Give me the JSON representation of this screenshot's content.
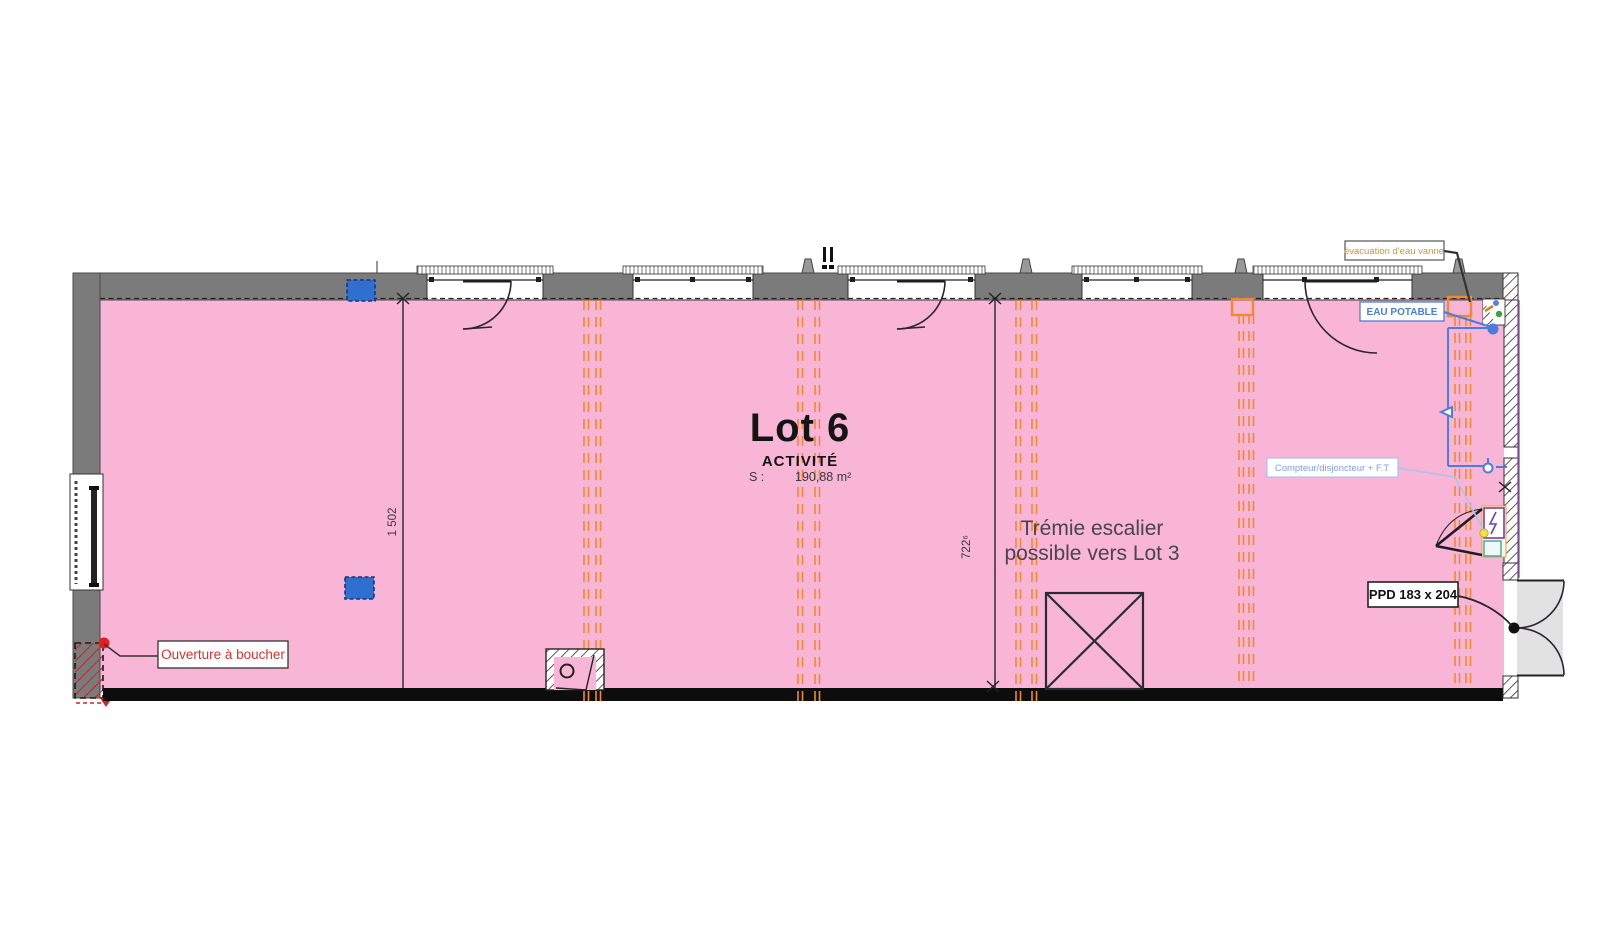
{
  "plan": {
    "lot": {
      "title": "Lot 6",
      "category": "ACTIVITÉ",
      "surface_label": "S :",
      "surface_value": "190,88 m²"
    },
    "notes": {
      "tremie_line1": "Trémie escalier",
      "tremie_line2": "possible vers Lot 3",
      "ouverture": "Ouverture à boucher",
      "ppd": "PPD 183 x 204",
      "eau_potable": "EAU POTABLE",
      "compteur": "Compteur/disjoncteur + F.T",
      "evacuation": "évacuation d'eau vanne"
    },
    "dimensions": {
      "width_axis": "1 502",
      "depth_axis": "722⁶"
    },
    "colors": {
      "floor": "#F8B5D6",
      "wall": "#7B7B7B",
      "axis": "#F08A2E",
      "water": "#4A7DE0",
      "compteur_label": "#7D9EF5",
      "alert_red": "#D63333",
      "evacuation_text": "#CF9440",
      "door_exterior": "#E2E2E2"
    }
  }
}
